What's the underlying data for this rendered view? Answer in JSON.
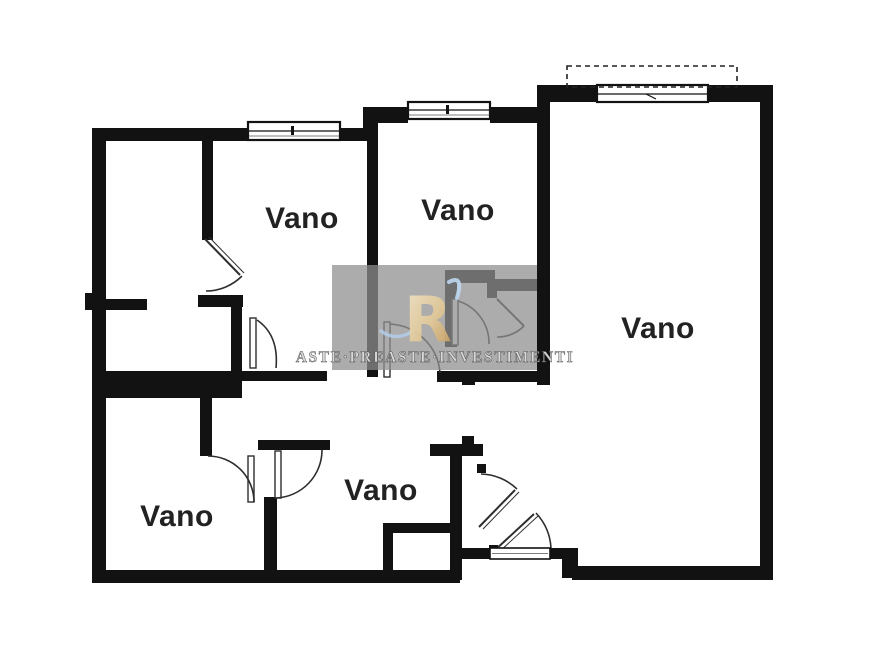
{
  "canvas": {
    "background": "#ffffff"
  },
  "plan": {
    "rooms": [
      {
        "id": "room-top-left",
        "label": "Vano"
      },
      {
        "id": "room-top-middle",
        "label": "Vano"
      },
      {
        "id": "room-right",
        "label": "Vano"
      },
      {
        "id": "room-bottom-left",
        "label": "Vano"
      },
      {
        "id": "room-bottom-middle",
        "label": "Vano"
      }
    ],
    "colors": {
      "wall": "#121212",
      "room_fill": "#ffffff",
      "door_stroke": "#2e2e2e"
    }
  },
  "watermark": {
    "monogram": "R",
    "company": "ASTE·PREASTE·INVESTIMENTI",
    "colors": {
      "background": "#989898",
      "gold_light": "#f0e2c4",
      "gold_dark": "#c2995c",
      "blue": "#bdd6f0",
      "text": "#d9d9d9"
    }
  }
}
